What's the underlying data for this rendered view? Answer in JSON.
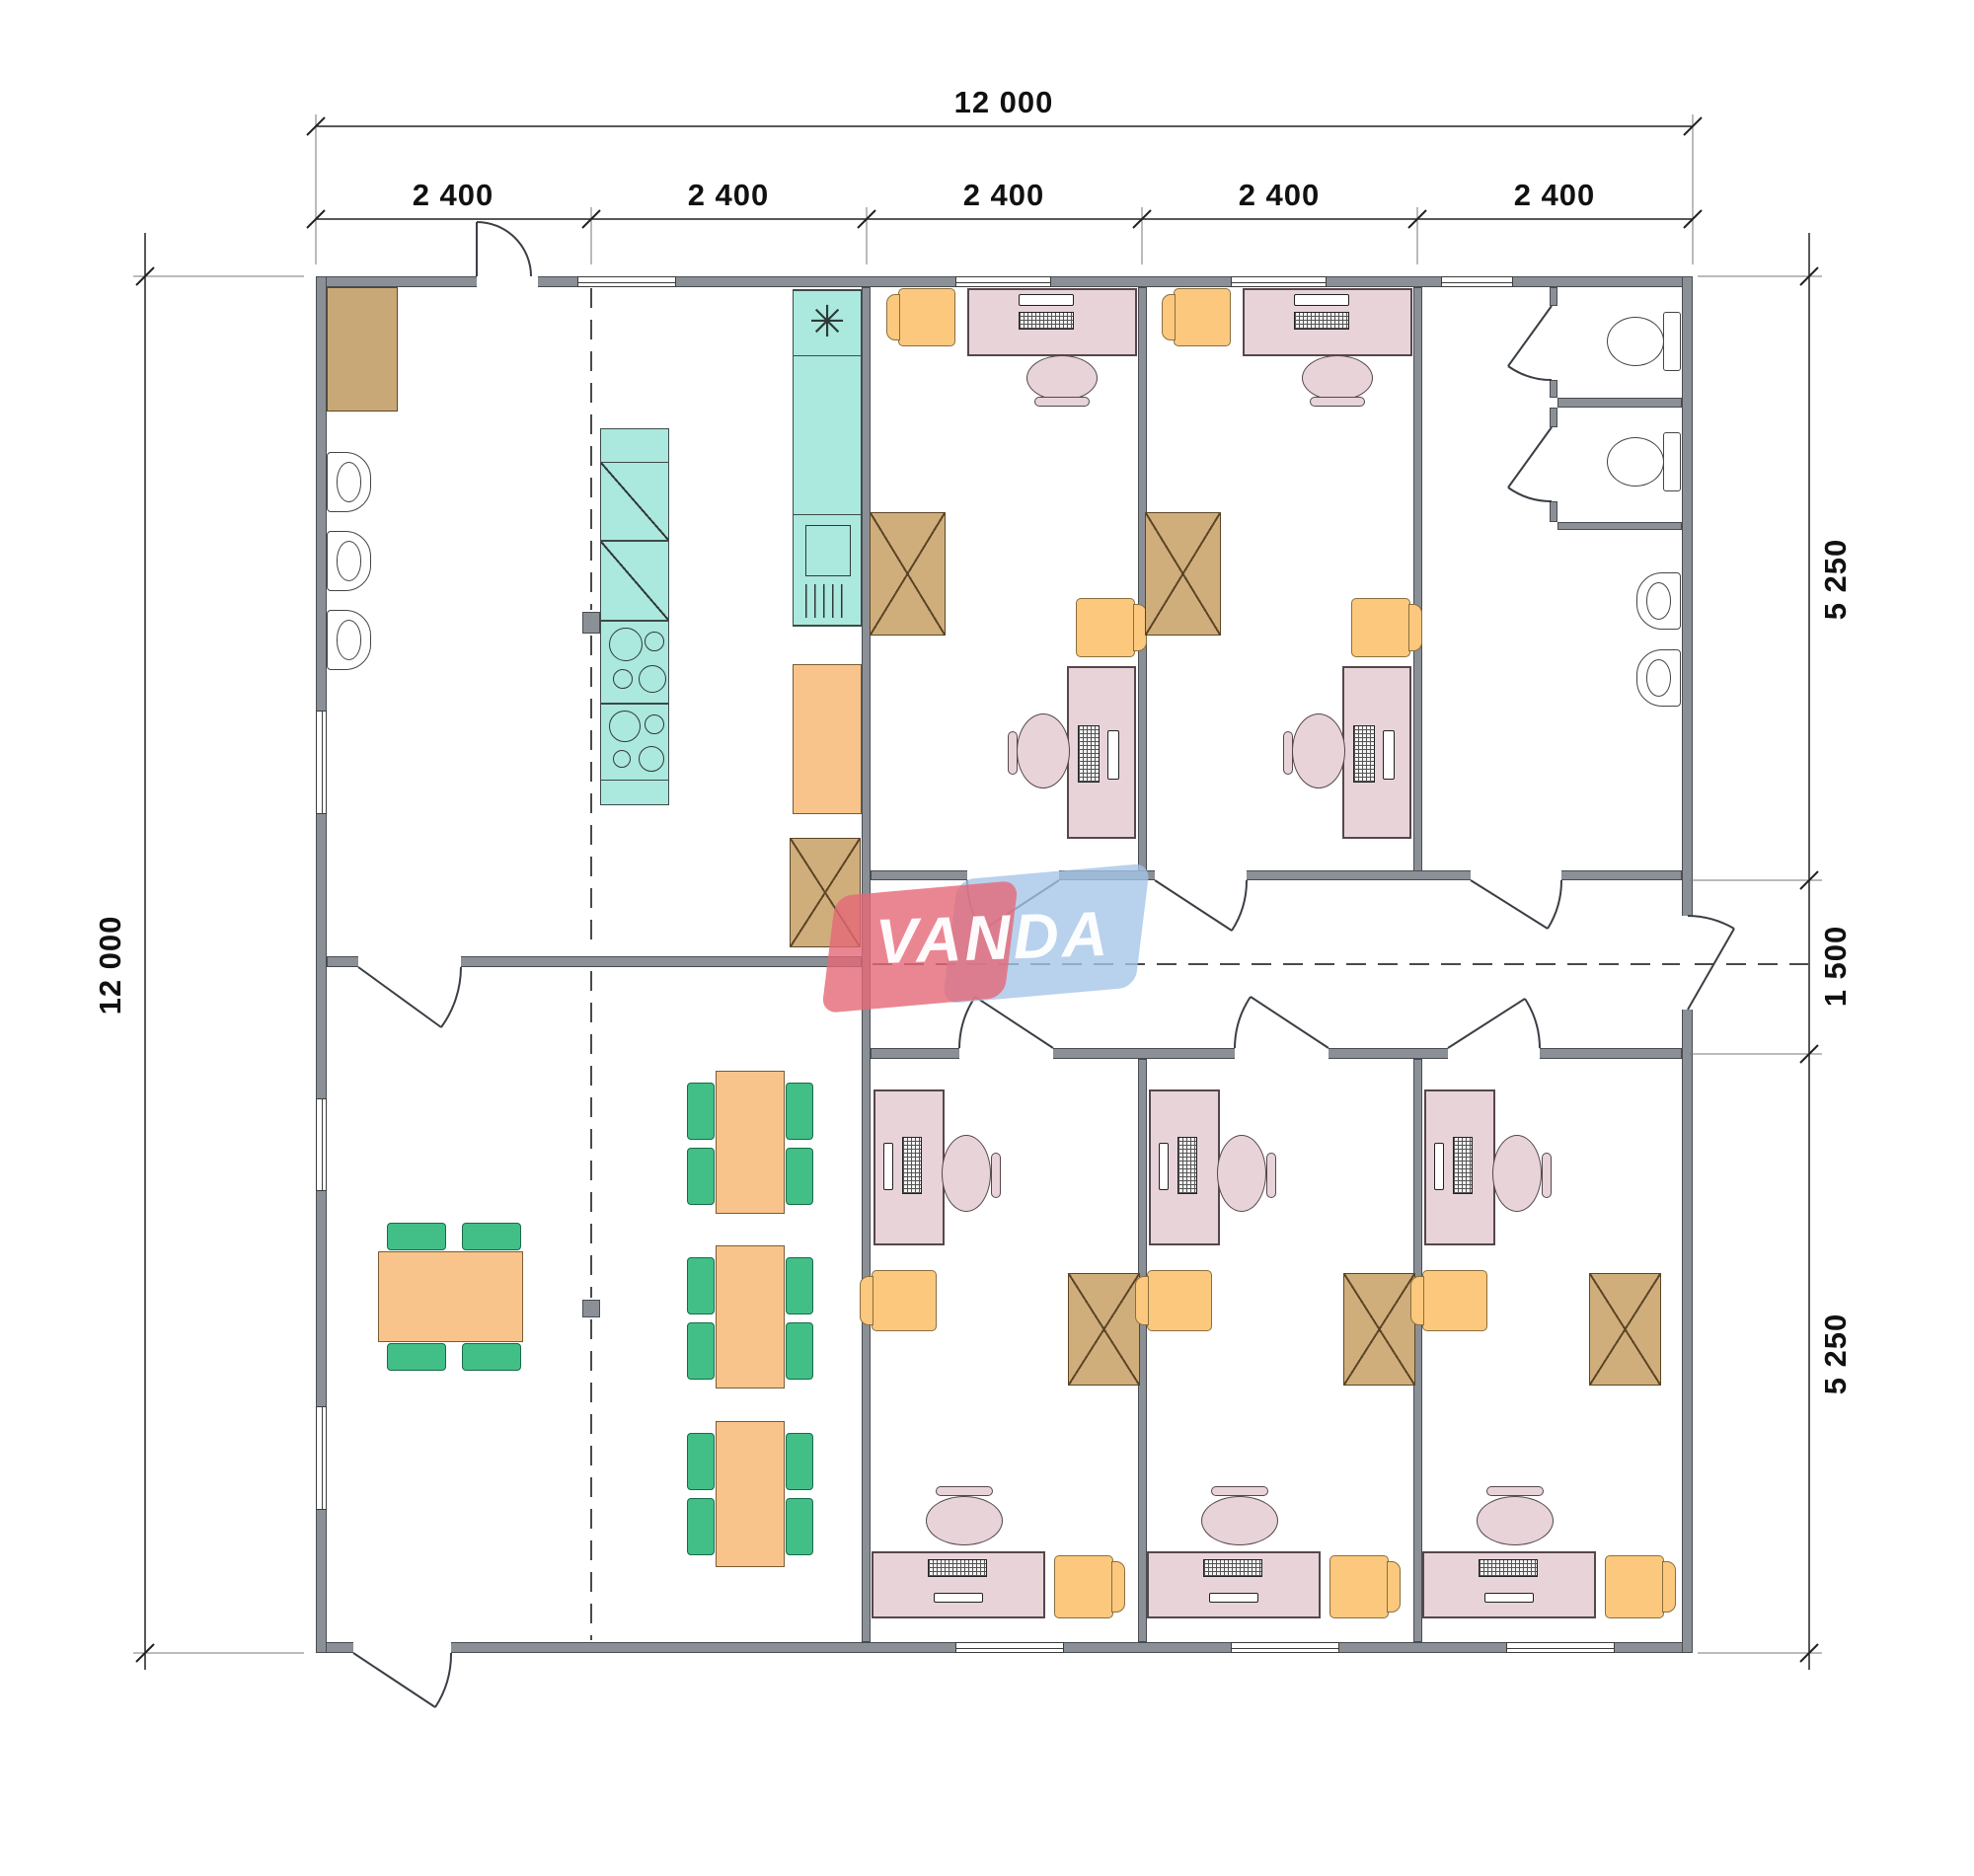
{
  "logo": {
    "text": "VANDA",
    "red": "#e4707d",
    "blue": "#b7cee9"
  },
  "dims": {
    "overall_top": "12 000",
    "overall_left": "12 000",
    "top_segments": [
      "2 400",
      "2 400",
      "2 400",
      "2 400",
      "2 400"
    ],
    "right_segments": [
      "5 250",
      "1 500",
      "5 250"
    ]
  },
  "icons": {
    "fridge_glyph": "✳"
  },
  "colors": {
    "wall": "#8b9097",
    "furniture_pink": "#e8d3d9",
    "furniture_yellow": "#fbc87e",
    "storage_tan": "#cfae7c",
    "kitchen_teal": "#abe8dd",
    "table_orange": "#f9c48b",
    "chair_green": "#42bf87"
  }
}
